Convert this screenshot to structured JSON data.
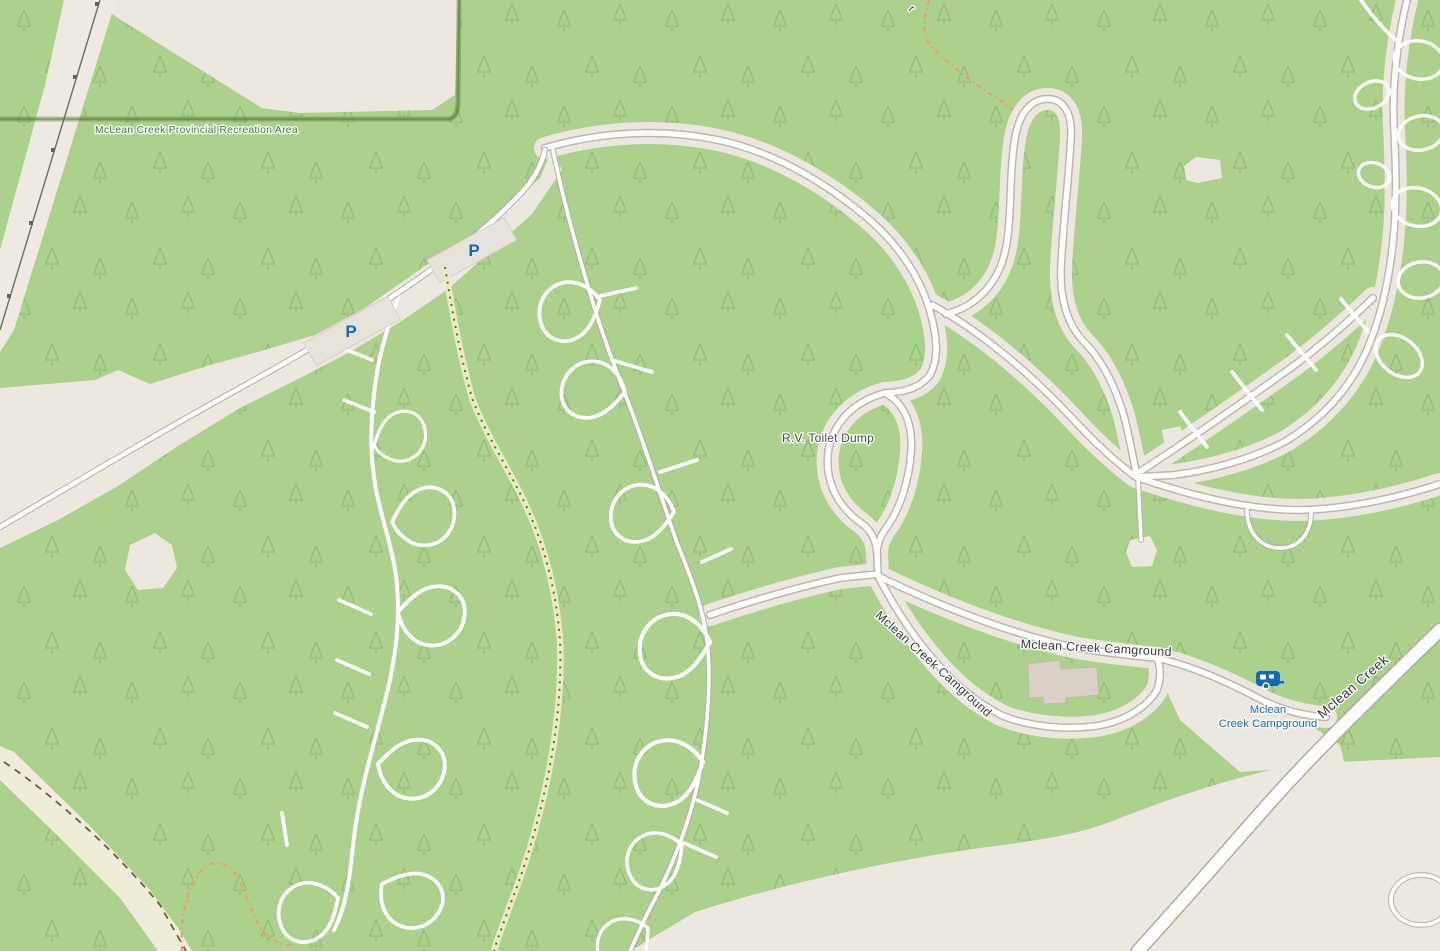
{
  "map": {
    "type": "openstreetmap-style campground map",
    "labels": {
      "protected_area": "McLean Creek Provincial Recreation Area",
      "rv_toilet_dump": "R.V. Toilet Dump",
      "road_campground_horizontal": "Mclean Creek Camground",
      "road_campground_diagonal": "Mclean Creek Camground",
      "road_main": "Mclean Creek",
      "campground_poi_line1": "Mclean",
      "campground_poi_line2": "Creek Campground",
      "trail_label_partial": "r",
      "parking_symbol": "P"
    },
    "icons": {
      "parking_count": 2,
      "caravan_site": "caravan-site-icon"
    },
    "colors": {
      "forest_green": "#abd18d",
      "tree_symbol": "#7fa66b",
      "clearing_beige": "#ece8df",
      "road_white": "#fdfdfc",
      "road_casing_gray": "#b5b1aa",
      "track_stipple": "#b2ada4",
      "boundary_green": "#557d37",
      "protected_label_green": "#3a7d35",
      "poi_blue": "#1569b4",
      "parking_blue": "#0b6ac1",
      "path_red_dash": "#a04a2a",
      "path_band_green": "#e4eec6",
      "trail_orange": "#ee9b6e",
      "cutline_dash_olive": "#6e6030",
      "power_line_gray": "#6b6b6b",
      "building_fill": "#d9d0c7"
    }
  }
}
